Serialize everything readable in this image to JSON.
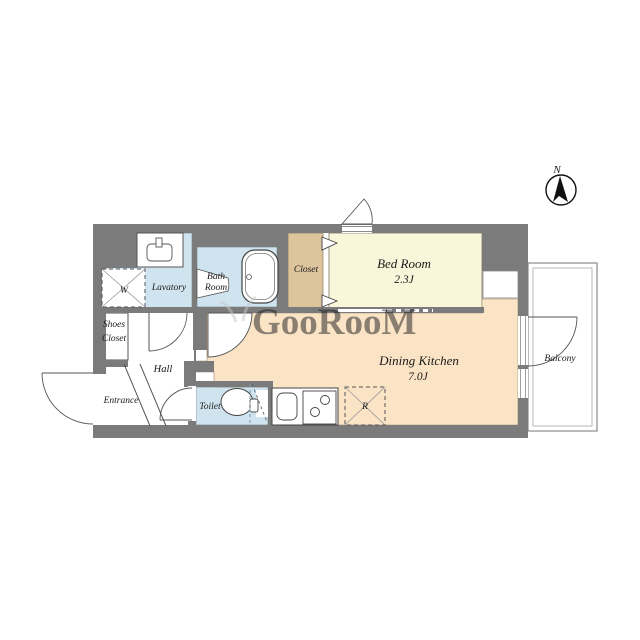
{
  "document": {
    "type": "apartment-floor-plan"
  },
  "compass": {
    "label": "N"
  },
  "watermark": {
    "text": "GooRooM"
  },
  "rooms": {
    "lavatory": {
      "label": "Lavatory"
    },
    "bath_room": {
      "line1": "Bath",
      "line2": "Room"
    },
    "closet": {
      "label": "Closet"
    },
    "bed_room": {
      "name": "Bed Room",
      "area": "2.3J"
    },
    "shoes_closet": {
      "line1": "Shoes",
      "line2": "Closet"
    },
    "hall": {
      "label": "Hall"
    },
    "entrance": {
      "label": "Entrance"
    },
    "toilet": {
      "label": "Toilet"
    },
    "dining_kitchen": {
      "name": "Dining Kitchen",
      "area": "7.0J"
    },
    "balcony": {
      "label": "Balcony"
    }
  },
  "appliances": {
    "washing_machine": "W",
    "refrigerator": "R"
  },
  "colors": {
    "wall": "#7b7b7b",
    "wet_room": "#cfe4ee",
    "bedroom": "#f9f6da",
    "closet": "#dcc49c",
    "dining_kitchen": "#fbe4c6",
    "watermark": "#c8c8c8"
  }
}
